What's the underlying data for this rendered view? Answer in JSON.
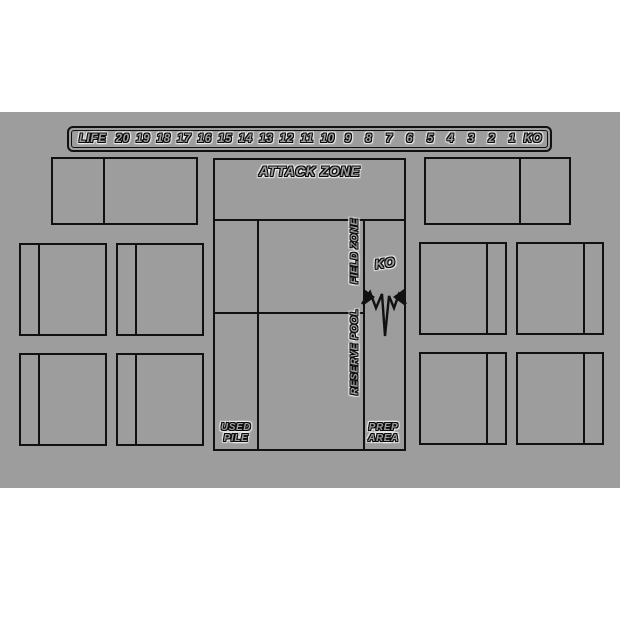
{
  "page": {
    "background": "#ffffff"
  },
  "mat": {
    "background": "#9d9d9d",
    "line_color": "#111111"
  },
  "life_track": {
    "label": "LIFE",
    "cells": [
      "20",
      "19",
      "18",
      "17",
      "16",
      "15",
      "14",
      "13",
      "12",
      "11",
      "10",
      "9",
      "8",
      "7",
      "6",
      "5",
      "4",
      "3",
      "2",
      "1",
      "KO"
    ]
  },
  "center_panel": {
    "attack_zone_label": "ATTACK ZONE",
    "field_zone_label": "FIELD ZONE",
    "reserve_pool_label": "RESERVE POOL",
    "ko_label": "KO",
    "used_pile_label": "USED\nPILE",
    "prep_area_label": "PREP\nAREA"
  }
}
